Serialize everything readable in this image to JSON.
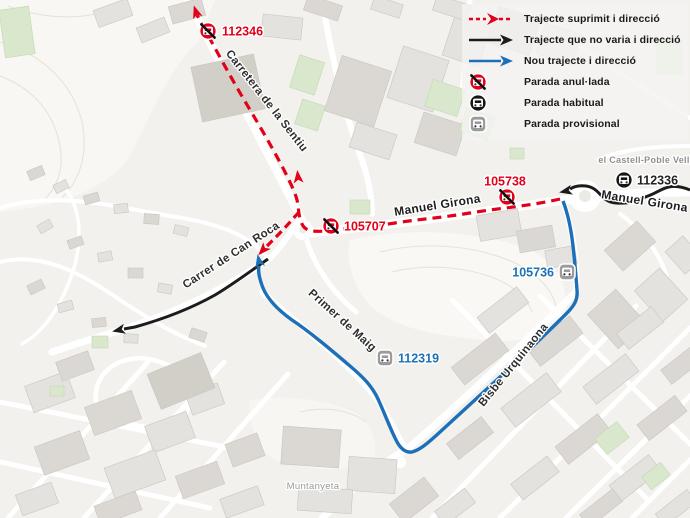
{
  "colors": {
    "suppressed": "#e2001a",
    "unchanged": "#1c1c1c",
    "new_route": "#1d70b8",
    "stop_regular": "#161616",
    "stop_provisional": "#9b9b9b",
    "map_background": "#f2f1ee"
  },
  "legend": {
    "items": [
      {
        "symbol": "dashed-arrow-red",
        "label": "Trajecte suprimit i direcció"
      },
      {
        "symbol": "arrow-black",
        "label": "Trajecte que no varia i direcció"
      },
      {
        "symbol": "arrow-blue",
        "label": "Nou trajecte i direcció"
      },
      {
        "symbol": "stop-cancelled",
        "label": "Parada anul·lada"
      },
      {
        "symbol": "stop-regular",
        "label": "Parada habitual"
      },
      {
        "symbol": "stop-provisional",
        "label": "Parada provisional"
      }
    ]
  },
  "map": {
    "stops": [
      {
        "id": "112346",
        "kind": "cancelled",
        "x": 208,
        "y": 31,
        "lx": 222,
        "ly": 31,
        "anchor": "start"
      },
      {
        "id": "105707",
        "kind": "cancelled",
        "x": 331,
        "y": 226,
        "lx": 344,
        "ly": 226,
        "anchor": "start"
      },
      {
        "id": "105738",
        "kind": "cancelled",
        "x": 507,
        "y": 197,
        "lx": 505,
        "ly": 181,
        "anchor": "middle"
      },
      {
        "id": "112336",
        "kind": "regular",
        "x": 624,
        "y": 180,
        "lx": 637,
        "ly": 180,
        "anchor": "start"
      },
      {
        "id": "105736",
        "kind": "provisional",
        "x": 567,
        "y": 272,
        "lx": 554,
        "ly": 272,
        "anchor": "end"
      },
      {
        "id": "112319",
        "kind": "provisional",
        "x": 385,
        "y": 358,
        "lx": 398,
        "ly": 358,
        "anchor": "start"
      }
    ],
    "street_labels": [
      {
        "text": "Carretera de la Sentiu",
        "x": 264,
        "y": 103,
        "rot": 52,
        "size": 11.5,
        "color": "#2e2e2e",
        "weight": "bold"
      },
      {
        "text": "Manuel Girona",
        "x": 438,
        "y": 209,
        "rot": -9,
        "size": 12,
        "color": "#1d1d1d",
        "weight": "bold"
      },
      {
        "text": "Manuel Girona",
        "x": 644,
        "y": 205,
        "rot": 9,
        "size": 12,
        "color": "#1d1d1d",
        "weight": "bold"
      },
      {
        "text": "Carrer de Can Roca",
        "x": 233,
        "y": 258,
        "rot": -33,
        "size": 11.5,
        "color": "#2e2e2e",
        "weight": "bold"
      },
      {
        "text": "Primer de Maig",
        "x": 340,
        "y": 323,
        "rot": 42,
        "size": 11.5,
        "color": "#2e2e2e",
        "weight": "bold"
      },
      {
        "text": "Bisbe Urquinaona",
        "x": 516,
        "y": 367,
        "rot": -51,
        "size": 11.5,
        "color": "#2e2e2e",
        "weight": "bold"
      },
      {
        "text": "el Castell-Poble Vell",
        "x": 644,
        "y": 163,
        "rot": 0,
        "size": 9,
        "color": "#8f8f8f",
        "weight": "bold"
      },
      {
        "text": "Muntanyeta",
        "x": 313,
        "y": 489,
        "rot": 0,
        "size": 9.5,
        "color": "#9a9a9a",
        "weight": "normal"
      }
    ]
  }
}
